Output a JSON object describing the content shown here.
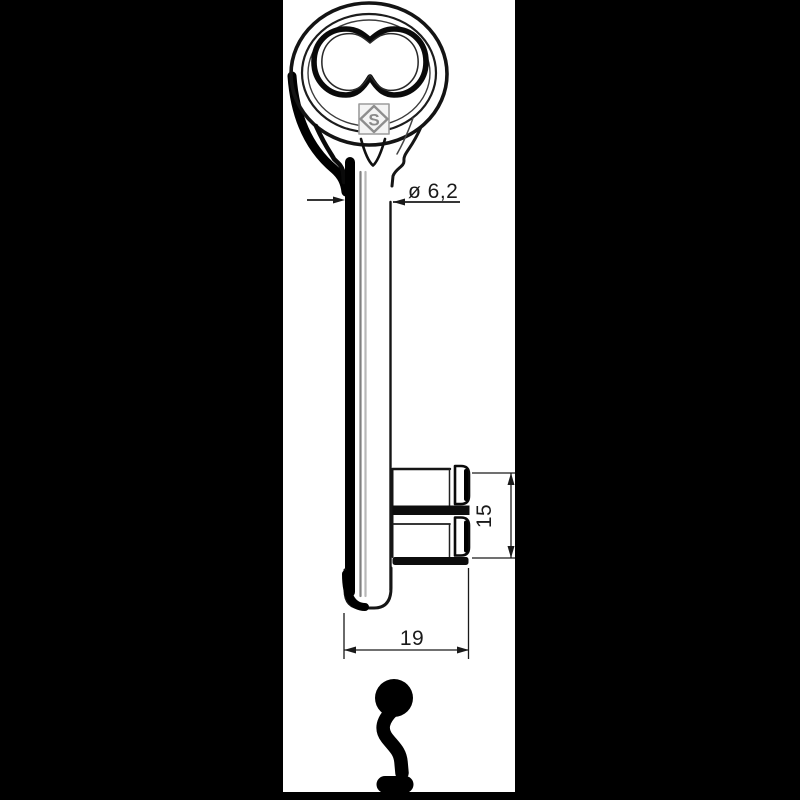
{
  "page": {
    "background": "#000000"
  },
  "panel": {
    "background": "#ffffff",
    "ink": "#1a1a1a"
  },
  "annotations": {
    "shaft_diameter": "ø 6,2",
    "bit_height": "15",
    "bit_width": "19"
  },
  "stamp": {
    "letter": "S"
  }
}
